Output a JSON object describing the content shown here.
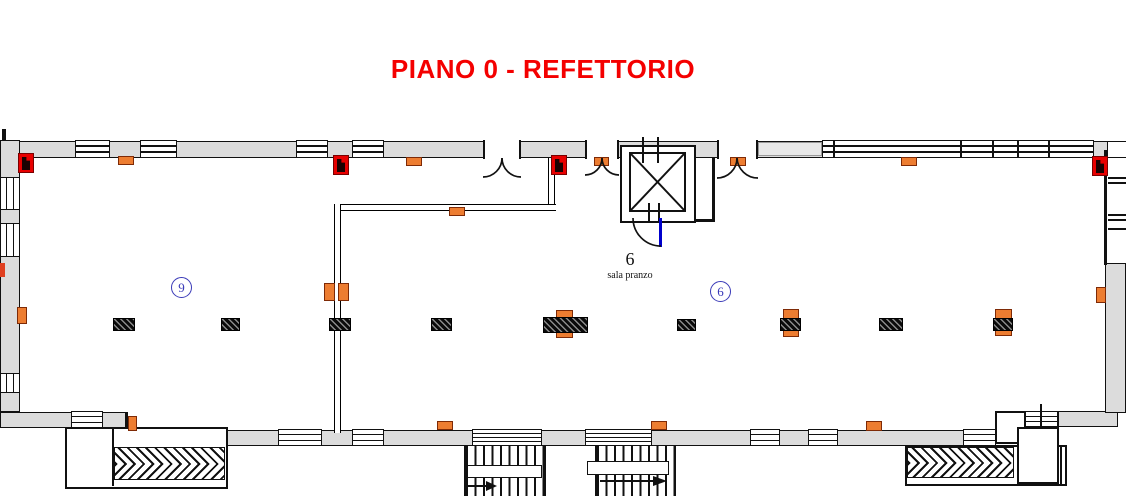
{
  "title": "PIANO 0 - REFETTORIO",
  "room": {
    "number": "6",
    "name": "sala pranzo"
  },
  "badges": [
    {
      "label": "9"
    },
    {
      "label": "6"
    }
  ],
  "colors": {
    "title_red": "#F40000",
    "wall_gray": "#DCDCDC",
    "marker_orange": "#ED7D31",
    "marker_red": "#E80000",
    "badge_blue": "#3A3AB8",
    "door_blue": "#0000CC"
  }
}
